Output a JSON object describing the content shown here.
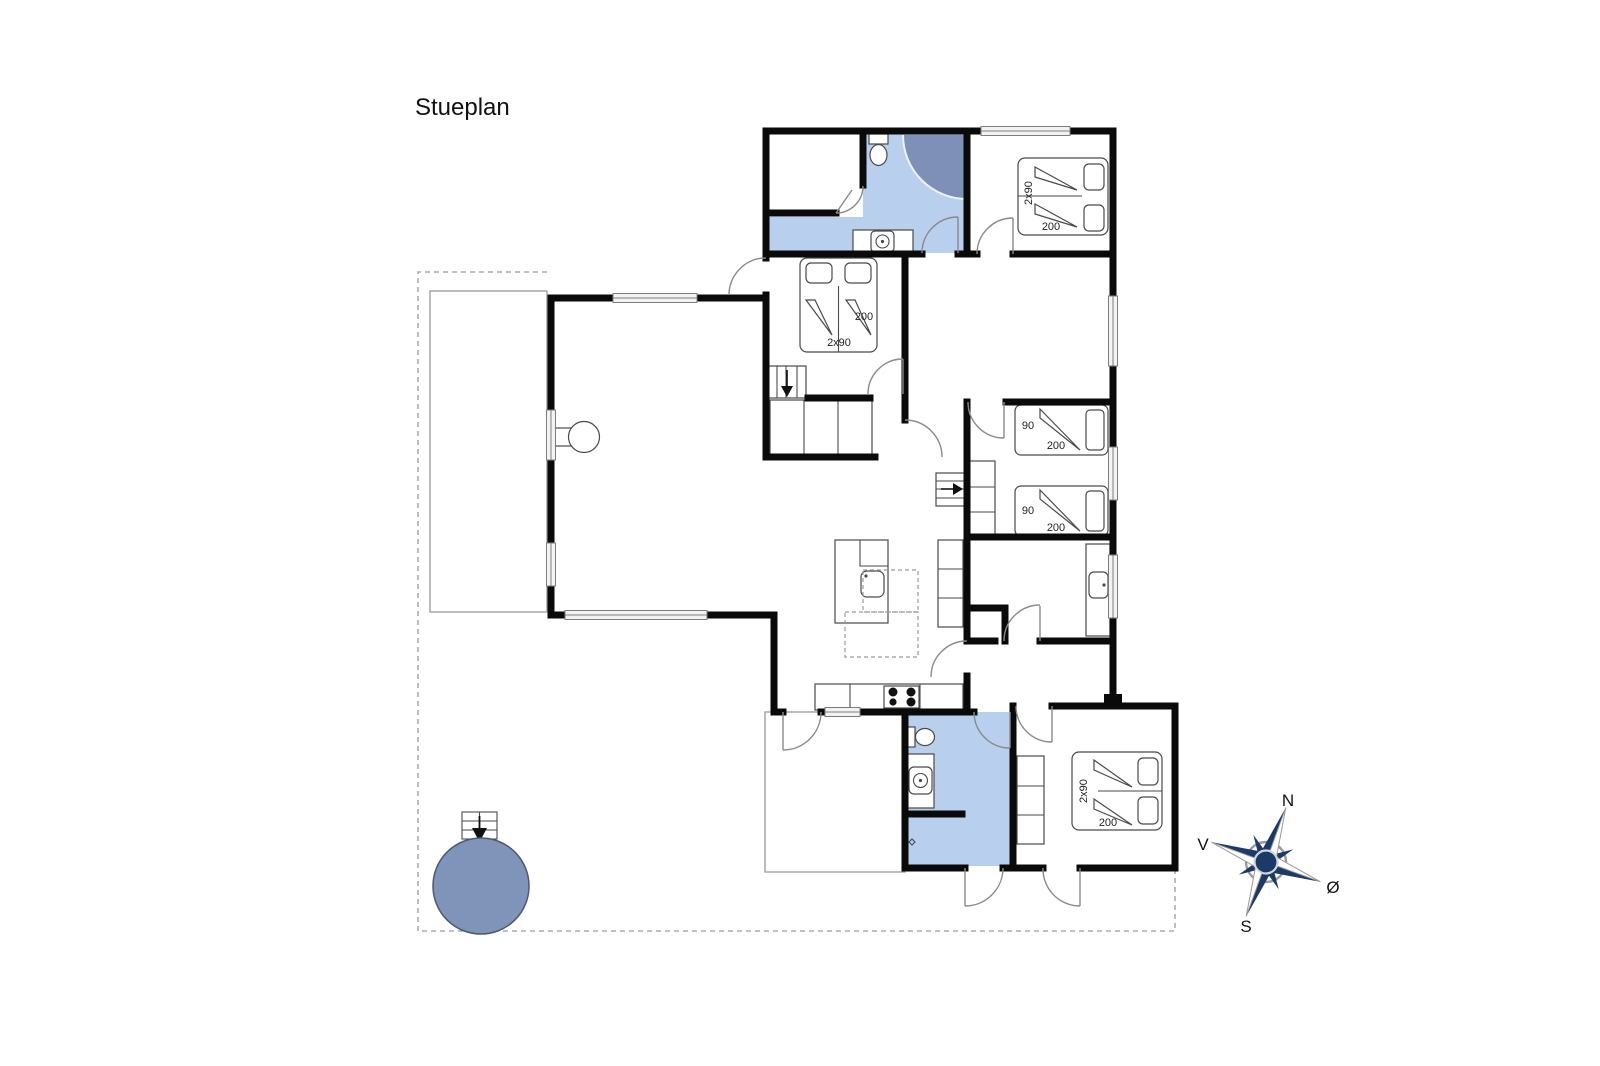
{
  "title": "Stueplan",
  "compass": {
    "north": "N",
    "south": "S",
    "west": "V",
    "east": "Ø"
  },
  "beds": {
    "top_right": {
      "width": "2x90",
      "length": "200"
    },
    "middle": {
      "width": "2x90",
      "length": "200"
    },
    "kids_top": {
      "width": "90",
      "length": "200"
    },
    "kids_bottom": {
      "width": "90",
      "length": "200"
    },
    "bottom_right": {
      "width": "2x90",
      "length": "200"
    }
  },
  "colors": {
    "wall": "#0a0a0a",
    "bathroom_fill": "#b9cfee",
    "shower_fill": "#7e90b8",
    "hot_tub_fill": "#8094ba",
    "compass_dark": "#1c3a68"
  }
}
